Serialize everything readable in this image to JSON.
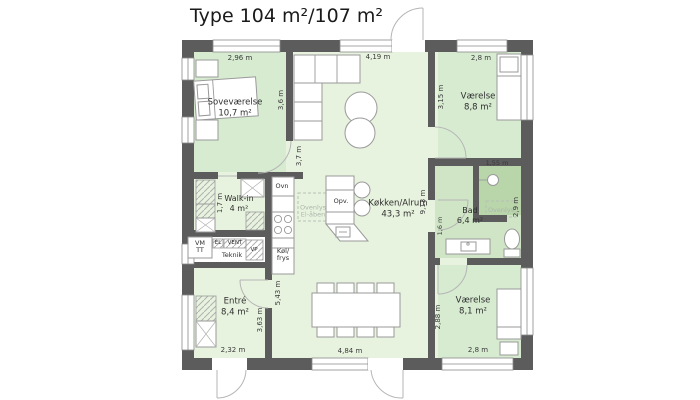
{
  "title": "Type 104 m²/107 m²",
  "rooms": {
    "sovevaerelse": {
      "name": "Soveværelse",
      "area": "10,7 m²"
    },
    "walkin": {
      "name": "Walk-in",
      "area": "4 m²"
    },
    "teknik": {
      "name": "Teknik"
    },
    "entre": {
      "name": "Entré",
      "area": "8,4 m²"
    },
    "kokken": {
      "name": "Køkken/Alrum",
      "area": "43,3 m²"
    },
    "vaerelse_top": {
      "name": "Værelse",
      "area": "8,8 m²"
    },
    "bad": {
      "name": "Bad",
      "area": "6,4 m²"
    },
    "vaerelse_bottom": {
      "name": "Værelse",
      "area": "8,1 m²"
    }
  },
  "appliances": {
    "ovn": "Ovn",
    "opv": "Opv.",
    "kol": "Køl/",
    "frys": "frys",
    "vm": "VM",
    "tt": "TT",
    "el": "EL",
    "vent": "VENT",
    "vp": "VP"
  },
  "skylights": {
    "kitchen_line1": "Ovenlys",
    "kitchen_line2": "El-åben",
    "bad": "Ovenlys"
  },
  "dimensions": {
    "d_296": "2,96 m",
    "d_419": "4,19 m",
    "d_28_top": "2,8 m",
    "d_36": "3,6 m",
    "d_37": "3,7 m",
    "d_315": "3,15 m",
    "d_17": "1,7 m",
    "d_155": "1,55 m",
    "d_29": "2,9 m",
    "d_913": "9,13 m",
    "d_16": "1,6 m",
    "d_543": "5,43 m",
    "d_363": "3,63 m",
    "d_288": "2,88 m",
    "d_232": "2,32 m",
    "d_484": "4,84 m",
    "d_28_bottom": "2,8 m"
  },
  "colors": {
    "wall": "#5c5c5c",
    "room_green": "#d7ebd1",
    "living_green": "#e8f3df",
    "bath_green": "#cfe5c6",
    "shower_green": "#b9d6ab",
    "skylight_gray": "#b7c0b4"
  }
}
